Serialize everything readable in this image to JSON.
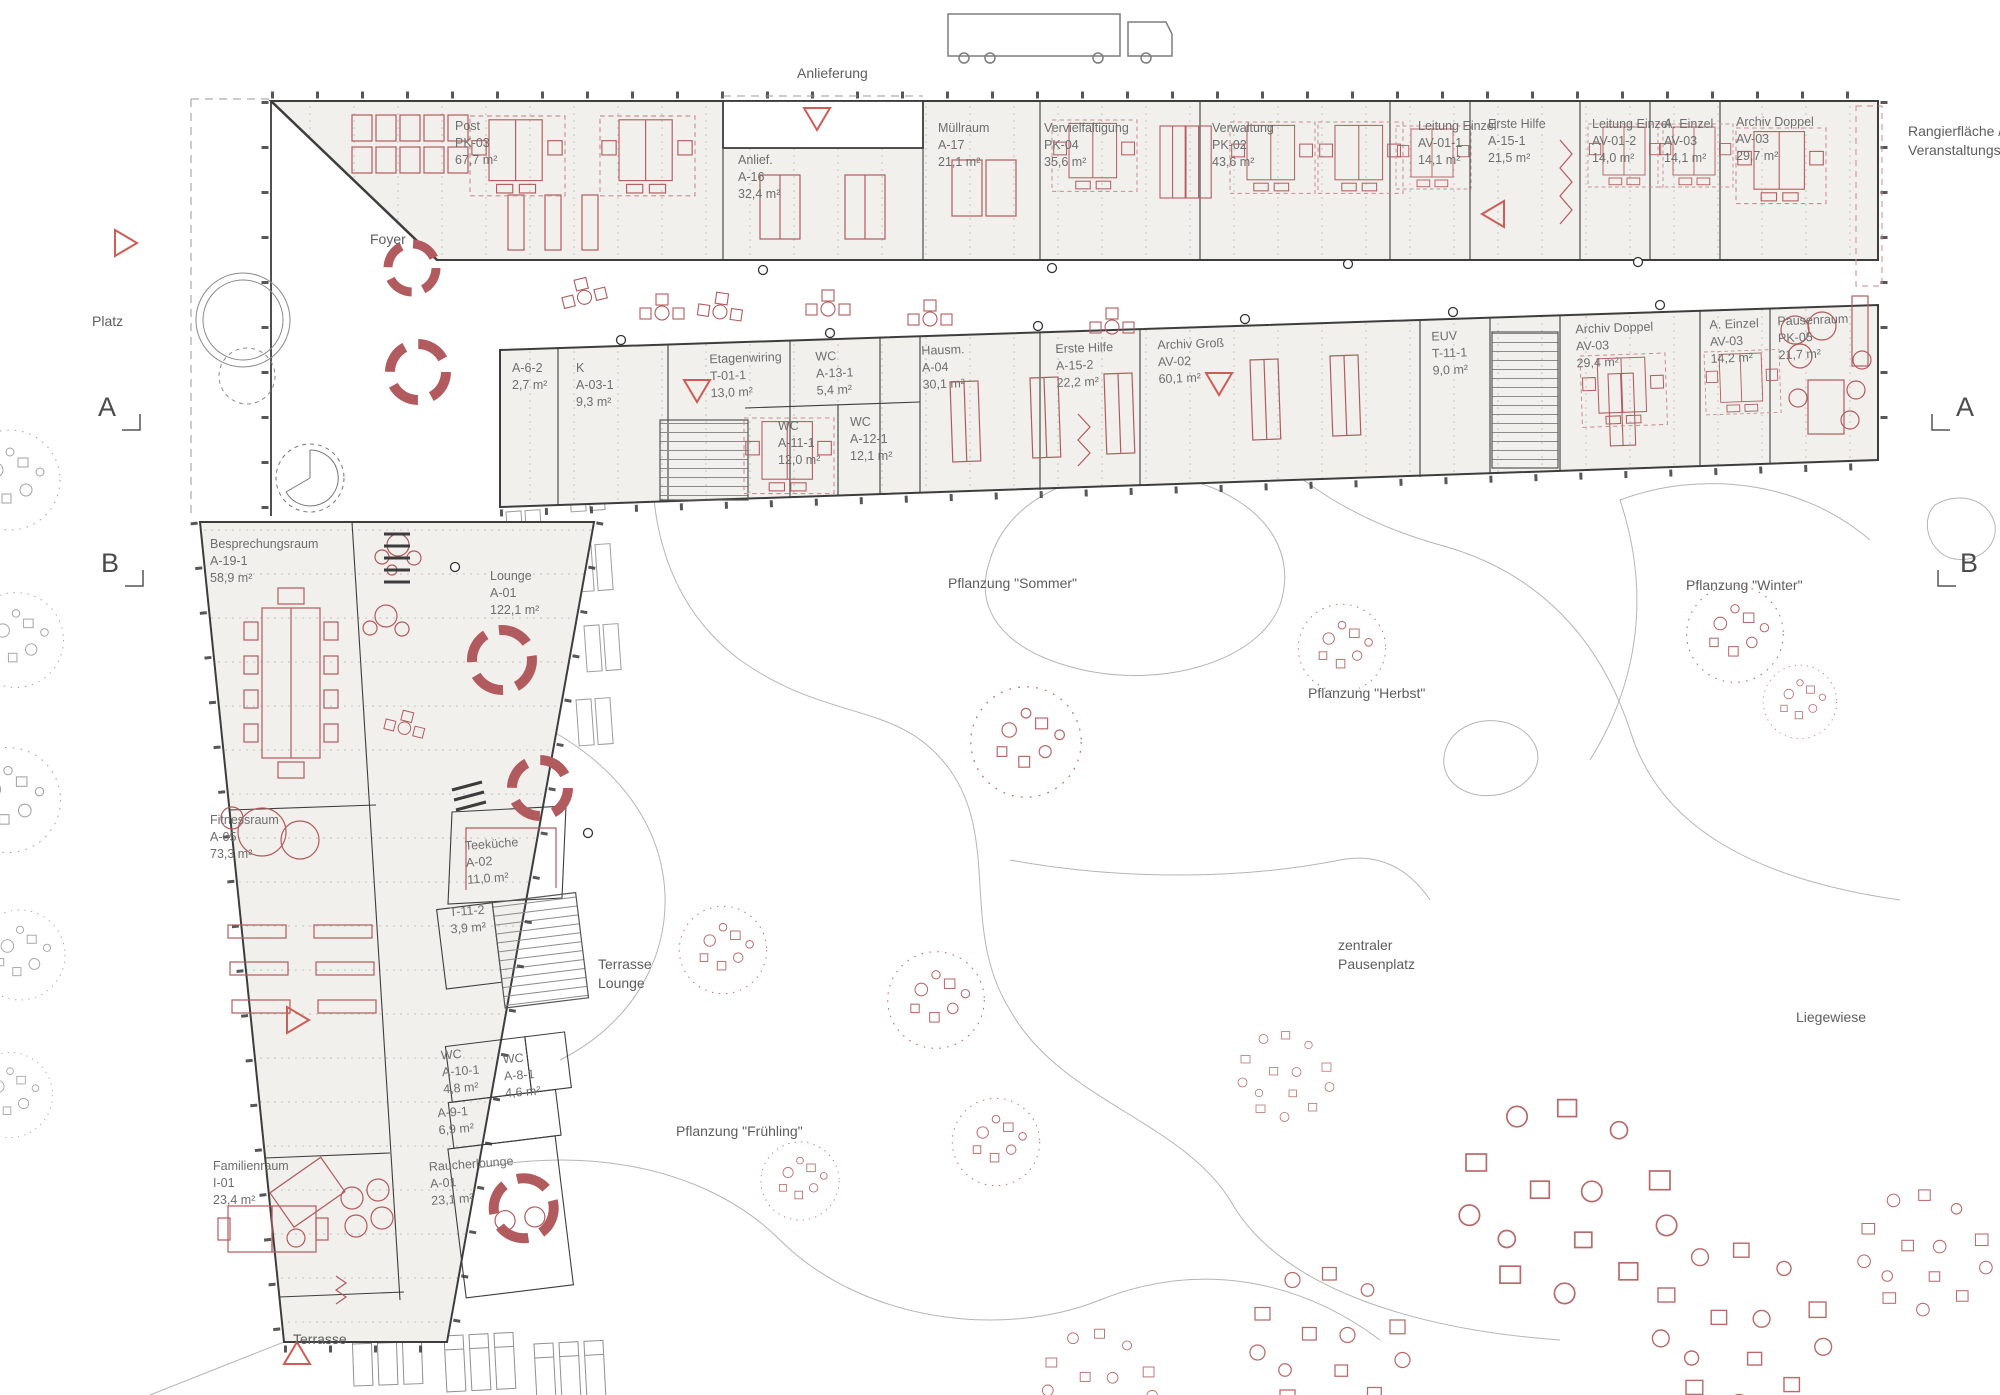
{
  "colors": {
    "room_fill": "#f1f0ed",
    "wall": "#3d3d3d",
    "furniture_red": "#b25b5e",
    "marker_red": "#cf5c56",
    "path_gray": "#b5b5b5",
    "label_gray": "#6e6e6e"
  },
  "site": {
    "anlieferung": "Anlieferung",
    "rangier_1": "Rangierfläche /",
    "rangier_2": "Veranstaltungsort",
    "platz": "Platz",
    "foyer": "Foyer",
    "terrasse_lounge_1": "Terrasse",
    "terrasse_lounge_2": "Lounge",
    "terrasse": "Terrasse",
    "pfl_sommer": "Pflanzung \"Sommer\"",
    "pfl_herbst": "Pflanzung \"Herbst\"",
    "pfl_winter": "Pflanzung \"Winter\"",
    "pfl_fruehling": "Pflanzung \"Frühling\"",
    "pausenplatz_1": "zentraler",
    "pausenplatz_2": "Pausenplatz",
    "liegewiese": "Liegewiese"
  },
  "sections": {
    "a": "A",
    "b": "B"
  },
  "rooms": {
    "post": {
      "name": "Post",
      "code": "PK-03",
      "area": "67,7 m²"
    },
    "anlief": {
      "name": "Anlief.",
      "code": "A-16",
      "area": "32,4 m²"
    },
    "muellraum": {
      "name": "Müllraum",
      "code": "A-17",
      "area": "21,1 m²"
    },
    "vervielfaeltigung": {
      "name": "Vervielfältigung",
      "code": "PK-04",
      "area": "35,6 m²"
    },
    "verwaltung": {
      "name": "Verwaltung",
      "code": "PK-02",
      "area": "43,6 m²"
    },
    "leitung_einzel_1": {
      "name": "Leitung Einzel",
      "code": "AV-01-1",
      "area": "14,1 m²"
    },
    "erste_hilfe_1": {
      "name": "Erste Hilfe",
      "code": "A-15-1",
      "area": "21,5 m²"
    },
    "leitung_einzel_2": {
      "name": "Leitung Einzel",
      "code": "AV-01-2",
      "area": "14,0 m²"
    },
    "a_einzel_1": {
      "name": "A. Einzel",
      "code": "AV-03",
      "area": "14,1 m²"
    },
    "archiv_doppel_1": {
      "name": "Archiv Doppel",
      "code": "AV-03",
      "area": "29,7 m²"
    },
    "a_6_2": {
      "code": "A-6-2",
      "area": "2,7 m²"
    },
    "k": {
      "name": "K",
      "code": "A-03-1",
      "area": "9,3 m²"
    },
    "etagenwiring": {
      "name": "Etagenwiring",
      "code": "T-01-1",
      "area": "13,0 m²"
    },
    "wc_a13": {
      "name": "WC",
      "code": "A-13-1",
      "area": "5,4 m²"
    },
    "wc_a11": {
      "name": "WC",
      "code": "A-11-1",
      "area": "12,0 m²"
    },
    "wc_a12": {
      "name": "WC",
      "code": "A-12-1",
      "area": "12,1 m²"
    },
    "hausm": {
      "name": "Hausm.",
      "code": "A-04",
      "area": "30,1 m²"
    },
    "erste_hilfe_2": {
      "name": "Erste Hilfe",
      "code": "A-15-2",
      "area": "22,2 m²"
    },
    "archiv_gross": {
      "name": "Archiv Groß",
      "code": "AV-02",
      "area": "60,1 m²"
    },
    "euv": {
      "name": "EUV",
      "code": "T-11-1",
      "area": "9,0 m²"
    },
    "archiv_doppel_2": {
      "name": "Archiv Doppel",
      "code": "AV-03",
      "area": "29,4 m²"
    },
    "a_einzel_2": {
      "name": "A. Einzel",
      "code": "AV-03",
      "area": "14,2 m²"
    },
    "pausenraum": {
      "name": "Pausenraum",
      "code": "PK-05",
      "area": "21,7 m²"
    },
    "besprechungsraum": {
      "name": "Besprechungsraum",
      "code": "A-19-1",
      "area": "58,9 m²"
    },
    "lounge": {
      "name": "Lounge",
      "code": "A-01",
      "area": "122,1 m²"
    },
    "fitnessraum": {
      "name": "Fitnessraum",
      "code": "A-05",
      "area": "73,3 m²"
    },
    "teekueche": {
      "name": "Teeküche",
      "code": "A-02",
      "area": "11,0 m²"
    },
    "t_11_2": {
      "code": "T-11-2",
      "area": "3,9 m²"
    },
    "wc_a10": {
      "name": "WC",
      "code": "A-10-1",
      "area": "4,8 m²"
    },
    "wc_a8": {
      "name": "WC",
      "code": "A-8-1",
      "area": "4,6 m²"
    },
    "a_9_1": {
      "code": "A-9-1",
      "area": "6,9 m²"
    },
    "familienraum": {
      "name": "Familienraum",
      "code": "I-01",
      "area": "23,4 m²"
    },
    "raucherlounge": {
      "name": "Raucherlounge",
      "code": "A-01",
      "area": "23,1 m²"
    }
  }
}
